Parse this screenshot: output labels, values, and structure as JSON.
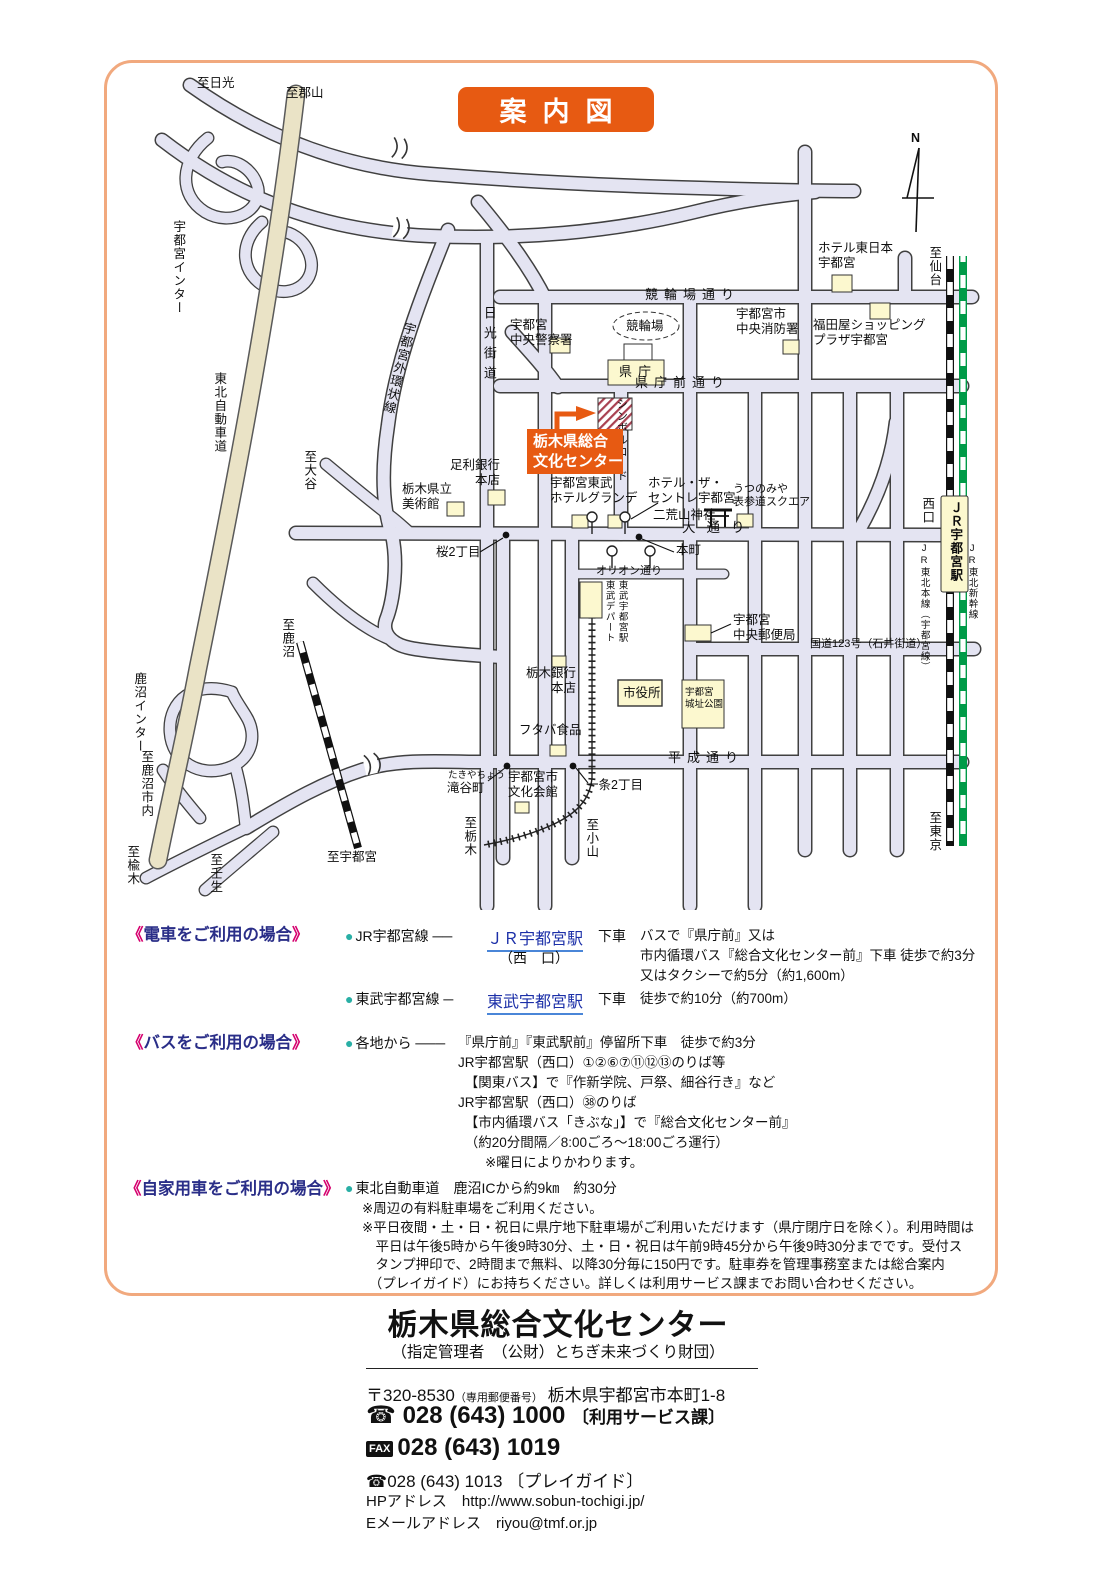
{
  "title": "案内図",
  "map": {
    "center_label": "栃木県総合\n文化センター",
    "labels": {
      "nikko": "至日光",
      "koriyama": "至郡山",
      "utsunomiya_ic": "宇都宮インター",
      "tohoku_expwy": "東北自動車道",
      "oya": "至大谷",
      "kanuma_rail": "至鹿沼",
      "kanuma_ic": "鹿沼インター",
      "kanuma_city": "至鹿沼市内",
      "niregi": "至楡木",
      "mibu": "至壬生",
      "to_utsunomiya": "至宇都宮",
      "to_tochigi": "至栃木",
      "to_oyama": "至小山",
      "sendai": "至仙台",
      "tokyo": "至東京",
      "nishiguchi": "西口",
      "jr_tohoku_line": "JR東北本線（宇都宮線）",
      "jr_shinkansen": "JR東北新幹線",
      "route123": "国道123号（石井街道）",
      "keirin_dori": "競輪場通り",
      "kencho_dori": "県庁前通り",
      "odori": "大通り",
      "orion_dori": "オリオン通り",
      "heisei_dori": "平成通り",
      "nikko_kaido": "日光街道",
      "symbol_road": "シンボルロード",
      "gaikanjo": "宇都宮外環状線",
      "police": "宇都宮\n中央警察署",
      "keirinjo": "競輪場",
      "kencho": "県庁",
      "hotel_higashi": "ホテル東日本\n宇都宮",
      "shobo": "宇都宮市\n中央消防署",
      "fukudaya": "福田屋ショッピング\nプラザ宇都宮",
      "ashikaga_bank": "足利銀行\n本店",
      "museum": "栃木県立\n美術館",
      "tobu_hotel": "宇都宮東武\nホテルグランデ",
      "hotel_centre": "ホテル・ザ・\nセントレ宇都宮",
      "futarasan": "二荒山神社",
      "omotesando": "うつのみや\n表参道スクエア",
      "hommachi": "本町",
      "sakura2": "桜2丁目",
      "tobu_dept": "東武デパート",
      "tobu_station": "東武宇都宮駅",
      "post_office": "宇都宮\n中央郵便局",
      "tochigi_bank": "栃木銀行\n本店",
      "shiyakusho": "市役所",
      "joshi_park": "宇都宮\n城址公園",
      "futaba": "フタバ食品",
      "bunka_kaikan": "宇都宮市\n文化会館",
      "takiya_kana": "たきやちょう",
      "takiya": "滝谷町",
      "ichijo2": "一条2丁目",
      "jr_station": "ＪＲ宇都宮駅",
      "compass_n": "N"
    }
  },
  "train": {
    "bracket_open": "《",
    "heading": "電車をご利用の場合",
    "bracket_close": "》",
    "rows": [
      {
        "bullet": "●",
        "line_name": "JR宇都宮線",
        "dash": "──",
        "station": "ＪＲ宇都宮駅",
        "station_sub": "（西　口）",
        "action": "下車",
        "details": "バスで『県庁前』又は\n市内循環バス『総合文化センター前』下車 徒歩で約3分\n又はタクシーで約5分（約1,600m）"
      },
      {
        "bullet": "●",
        "line_name": "東武宇都宮線",
        "dash": "─",
        "station": "東武宇都宮駅",
        "station_sub": "",
        "action": "下車",
        "details": "徒歩で約10分（約700m）"
      }
    ]
  },
  "bus": {
    "bracket_open": "《",
    "heading": "バスをご利用の場合",
    "bracket_close": "》",
    "bullet": "●",
    "from": "各地から",
    "dash": "───",
    "details": "『県庁前』『東武駅前』停留所下車　徒歩で約3分\nJR宇都宮駅（西口）①②⑥⑦⑪⑫⑬のりば等\n　【関東バス】で『作新学院、戸祭、細谷行き』など\nJR宇都宮駅（西口）㊳のりば\n　【市内循環バス「きぶな」】で『総合文化センター前』\n　（約20分間隔／8:00ごろ～18:00ごろ運行）\n　　※曜日によりかわります。"
  },
  "car": {
    "bracket_open": "《",
    "heading": "自家用車をご利用の場合",
    "bracket_close": "》",
    "bullet": "●",
    "route": "東北自動車道　鹿沼ICから約9㎞　約30分",
    "note1": "※周辺の有料駐車場をご利用ください。",
    "note2": "※平日夜間・土・日・祝日に県庁地下駐車場がご利用いただけます（県庁閉庁日を除く）。利用時間は\n　平日は午後5時から午後9時30分、土・日・祝日は午前9時45分から午後9時30分までです。受付ス\n　タンプ押印で、2時間まで無料、以降30分毎に150円です。駐車券を管理事務室または総合案内\n　（プレイガイド）にお持ちください。詳しくは利用サービス課までお問い合わせください。"
  },
  "footer": {
    "name": "栃木県総合文化センター",
    "manager": "（指定管理者　（公財）とちぎ未来づくり財団）",
    "postal_code": "〒320-8530",
    "postal_note": "（専用郵便番号）",
    "address": "栃木県宇都宮市本町1-8",
    "tel1_icon": "☎",
    "tel1": "028 (643) 1000",
    "tel1_dept": "〔利用サービス課〕",
    "fax_label": "FAX",
    "fax": "028 (643) 1019",
    "tel2_icon": "☎",
    "tel2": "028 (643) 1013",
    "tel2_dept": "〔プレイガイド〕",
    "hp_label": "HPアドレス",
    "hp": "http://www.sobun-tochigi.jp/",
    "email_label": "Eメールアドレス",
    "email": "riyou@tmf.or.jp"
  }
}
